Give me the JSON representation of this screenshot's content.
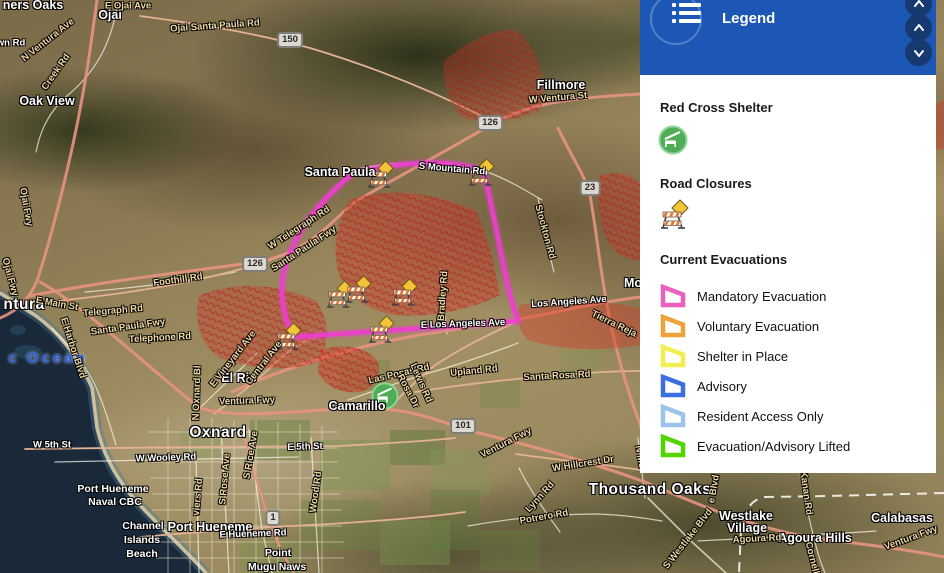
{
  "panel": {
    "title": "Legend",
    "colors": {
      "header_bg": "#1d57b6",
      "button_bg": "#16396f"
    },
    "sections": {
      "shelter_heading": "Red Cross Shelter",
      "closures_heading": "Road Closures",
      "evac_heading": "Current Evacuations"
    },
    "evacuation_items": [
      {
        "label": "Mandatory Evacuation",
        "color": "#ea5fc0"
      },
      {
        "label": "Voluntary Evacuation",
        "color": "#eda23d"
      },
      {
        "label": "Shelter in Place",
        "color": "#f0ee51"
      },
      {
        "label": "Advisory",
        "color": "#3b6fe0"
      },
      {
        "label": "Resident Access Only",
        "color": "#9cc3ea"
      },
      {
        "label": "Evacuation/Advisory Lifted",
        "color": "#55d400"
      }
    ]
  },
  "map": {
    "colors": {
      "evac_boundary": "#ee3ecf",
      "fire_area": "#d63426",
      "highway": "#e89380",
      "ocean": "#19293a"
    },
    "labels": [
      {
        "t": "ners Oaks",
        "x": 33,
        "y": 5,
        "c": "city"
      },
      {
        "t": "Ojai",
        "x": 110,
        "y": 15,
        "c": "city"
      },
      {
        "t": "Oak View",
        "x": 47,
        "y": 101,
        "c": "city"
      },
      {
        "t": "Santa Paula",
        "x": 340,
        "y": 172,
        "c": "city"
      },
      {
        "t": "Fillmore",
        "x": 561,
        "y": 85,
        "c": "city"
      },
      {
        "t": "El Rio",
        "x": 239,
        "y": 378,
        "c": "city"
      },
      {
        "t": "Camarillo",
        "x": 357,
        "y": 406,
        "c": "city"
      },
      {
        "t": "Mo",
        "x": 633,
        "y": 283,
        "c": "city"
      },
      {
        "t": "ntura",
        "x": 24,
        "y": 305,
        "c": "big"
      },
      {
        "t": "Oxnard",
        "x": 218,
        "y": 433,
        "c": "big"
      },
      {
        "t": "Thousand Oaks",
        "x": 650,
        "y": 490,
        "c": "big"
      },
      {
        "t": "Westlake",
        "x": 746,
        "y": 516,
        "c": "city"
      },
      {
        "t": "Village",
        "x": 747,
        "y": 528,
        "c": "city"
      },
      {
        "t": "Agoura Hills",
        "x": 815,
        "y": 538,
        "c": "city"
      },
      {
        "t": "Calabasas",
        "x": 902,
        "y": 518,
        "c": "city"
      },
      {
        "t": "Port Hueneme",
        "x": 210,
        "y": 527,
        "c": "city"
      },
      {
        "t": "Port Hueneme",
        "x": 113,
        "y": 489,
        "c": "town"
      },
      {
        "t": "Naval CBC",
        "x": 115,
        "y": 502,
        "c": "town"
      },
      {
        "t": "Channel",
        "x": 143,
        "y": 526,
        "c": "town"
      },
      {
        "t": "Islands",
        "x": 142,
        "y": 540,
        "c": "town"
      },
      {
        "t": "Beach",
        "x": 142,
        "y": 554,
        "c": "town"
      },
      {
        "t": "Point",
        "x": 278,
        "y": 553,
        "c": "town"
      },
      {
        "t": "Mugu Naws",
        "x": 277,
        "y": 567,
        "c": "town"
      },
      {
        "t": "c  Ocean",
        "x": 48,
        "y": 358,
        "c": "ocean"
      },
      {
        "t": "E Ojai Ave",
        "x": 128,
        "y": 6,
        "c": "tan"
      },
      {
        "t": "Ojai Santa Paula Rd",
        "x": 215,
        "y": 26,
        "r": -4,
        "c": "tan"
      },
      {
        "t": "N Ventura Ave",
        "x": 48,
        "y": 40,
        "r": -38,
        "c": "tan"
      },
      {
        "t": "wn Rd",
        "x": 11,
        "y": 43,
        "c": "road"
      },
      {
        "t": "Creek Rd",
        "x": 56,
        "y": 72,
        "r": -55,
        "c": "tan"
      },
      {
        "t": "Ojai Fwy",
        "x": 26,
        "y": 207,
        "r": 80,
        "c": "tan"
      },
      {
        "t": "Ojai Fwy",
        "x": 10,
        "y": 277,
        "r": 75,
        "c": "tan"
      },
      {
        "t": "W Telegraph Rd",
        "x": 299,
        "y": 228,
        "r": -33,
        "c": "tan"
      },
      {
        "t": "Santa Paula Fwy",
        "x": 304,
        "y": 249,
        "r": -33,
        "c": "tan"
      },
      {
        "t": "Foothill Rd",
        "x": 178,
        "y": 280,
        "r": -8,
        "c": "tan"
      },
      {
        "t": "E Main St",
        "x": 57,
        "y": 304,
        "r": 10,
        "c": "tan"
      },
      {
        "t": "Telegraph Rd",
        "x": 113,
        "y": 311,
        "r": -5,
        "c": "tan"
      },
      {
        "t": "Santa Paula Fwy",
        "x": 128,
        "y": 327,
        "r": -8,
        "c": "tan"
      },
      {
        "t": "Telephone Rd",
        "x": 160,
        "y": 338,
        "r": -3,
        "c": "tan"
      },
      {
        "t": "E Harbor Blvd",
        "x": 73,
        "y": 348,
        "r": 72,
        "c": "tan"
      },
      {
        "t": "S Mountain Rd",
        "x": 452,
        "y": 169,
        "r": 5,
        "c": "road"
      },
      {
        "t": "Stockton Rd",
        "x": 545,
        "y": 232,
        "r": 75,
        "c": "tan"
      },
      {
        "t": "W Ventura St",
        "x": 558,
        "y": 98,
        "r": -5,
        "c": "tan"
      },
      {
        "t": "Bradley Rd",
        "x": 443,
        "y": 296,
        "r": -86,
        "c": "tan"
      },
      {
        "t": "E Los Angeles Ave",
        "x": 463,
        "y": 324,
        "r": -2,
        "c": "road"
      },
      {
        "t": "Los Angeles Ave",
        "x": 569,
        "y": 302,
        "r": -4,
        "c": "road"
      },
      {
        "t": "Tierra Reja",
        "x": 614,
        "y": 324,
        "r": 26,
        "c": "tan"
      },
      {
        "t": "Santa Rosa Rd",
        "x": 557,
        "y": 376,
        "r": -3,
        "c": "tan"
      },
      {
        "t": "Las Posas Rd",
        "x": 399,
        "y": 374,
        "r": -13,
        "c": "tan"
      },
      {
        "t": "Upland Rd",
        "x": 474,
        "y": 371,
        "r": -6,
        "c": "tan"
      },
      {
        "t": "Lewis Rd",
        "x": 421,
        "y": 383,
        "r": 66,
        "c": "tan"
      },
      {
        "t": "Rosa Dr",
        "x": 408,
        "y": 391,
        "r": 62,
        "c": "tan"
      },
      {
        "t": "E Vineyard Ave",
        "x": 233,
        "y": 359,
        "r": -52,
        "c": "tan"
      },
      {
        "t": "Central Ave",
        "x": 264,
        "y": 363,
        "r": -52,
        "c": "tan"
      },
      {
        "t": "N Oxnard Bl",
        "x": 197,
        "y": 393,
        "r": -88,
        "c": "tan"
      },
      {
        "t": "Ventura Fwy",
        "x": 247,
        "y": 401,
        "r": -2,
        "c": "tan"
      },
      {
        "t": "W 5th St",
        "x": 52,
        "y": 445,
        "c": "road"
      },
      {
        "t": "E 5th St",
        "x": 305,
        "y": 447,
        "r": -2,
        "c": "road"
      },
      {
        "t": "W Wooley Rd",
        "x": 166,
        "y": 458,
        "r": -2,
        "c": "road"
      },
      {
        "t": "S Rose Ave",
        "x": 225,
        "y": 479,
        "r": -85,
        "c": "tan"
      },
      {
        "t": "S Rice Ave",
        "x": 251,
        "y": 455,
        "r": -80,
        "c": "tan"
      },
      {
        "t": "viers Rd",
        "x": 198,
        "y": 497,
        "r": -85,
        "c": "tan"
      },
      {
        "t": "Wood Rd",
        "x": 316,
        "y": 492,
        "r": -82,
        "c": "tan"
      },
      {
        "t": "E Hueneme Rd",
        "x": 253,
        "y": 534,
        "r": -2,
        "c": "road"
      },
      {
        "t": "Ventura Fwy",
        "x": 506,
        "y": 443,
        "r": -27,
        "c": "tan"
      },
      {
        "t": "W Hillcrest Dr",
        "x": 583,
        "y": 464,
        "r": -9,
        "c": "tan"
      },
      {
        "t": "N Mo",
        "x": 640,
        "y": 457,
        "r": 80,
        "c": "tan"
      },
      {
        "t": "Lynn Rd",
        "x": 540,
        "y": 497,
        "r": -48,
        "c": "tan"
      },
      {
        "t": "Potrero Rd",
        "x": 544,
        "y": 517,
        "r": -10,
        "c": "tan"
      },
      {
        "t": "e Blvd",
        "x": 714,
        "y": 489,
        "r": -80,
        "c": "tan"
      },
      {
        "t": "Kanan Rd",
        "x": 806,
        "y": 493,
        "r": 82,
        "c": "tan"
      },
      {
        "t": "Agoura Rd",
        "x": 757,
        "y": 539,
        "r": -3,
        "c": "tan"
      },
      {
        "t": "S Westlake Blvd",
        "x": 688,
        "y": 539,
        "r": -52,
        "c": "tan"
      },
      {
        "t": "Ventura Fwy",
        "x": 911,
        "y": 538,
        "r": -20,
        "c": "tan"
      },
      {
        "t": "Cornell",
        "x": 812,
        "y": 558,
        "r": 76,
        "c": "tan"
      }
    ],
    "shields": [
      {
        "t": "150",
        "x": 290,
        "y": 40
      },
      {
        "t": "126",
        "x": 255,
        "y": 264
      },
      {
        "t": "126",
        "x": 490,
        "y": 123
      },
      {
        "t": "23",
        "x": 590,
        "y": 188
      },
      {
        "t": "101",
        "x": 463,
        "y": 426
      },
      {
        "t": "1",
        "x": 273,
        "y": 518
      }
    ],
    "closure_markers": [
      {
        "x": 381,
        "y": 174
      },
      {
        "x": 482,
        "y": 172
      },
      {
        "x": 340,
        "y": 294
      },
      {
        "x": 359,
        "y": 289
      },
      {
        "x": 405,
        "y": 292
      },
      {
        "x": 289,
        "y": 336
      },
      {
        "x": 382,
        "y": 329
      }
    ],
    "shelter_marker": {
      "x": 385,
      "y": 396
    }
  }
}
